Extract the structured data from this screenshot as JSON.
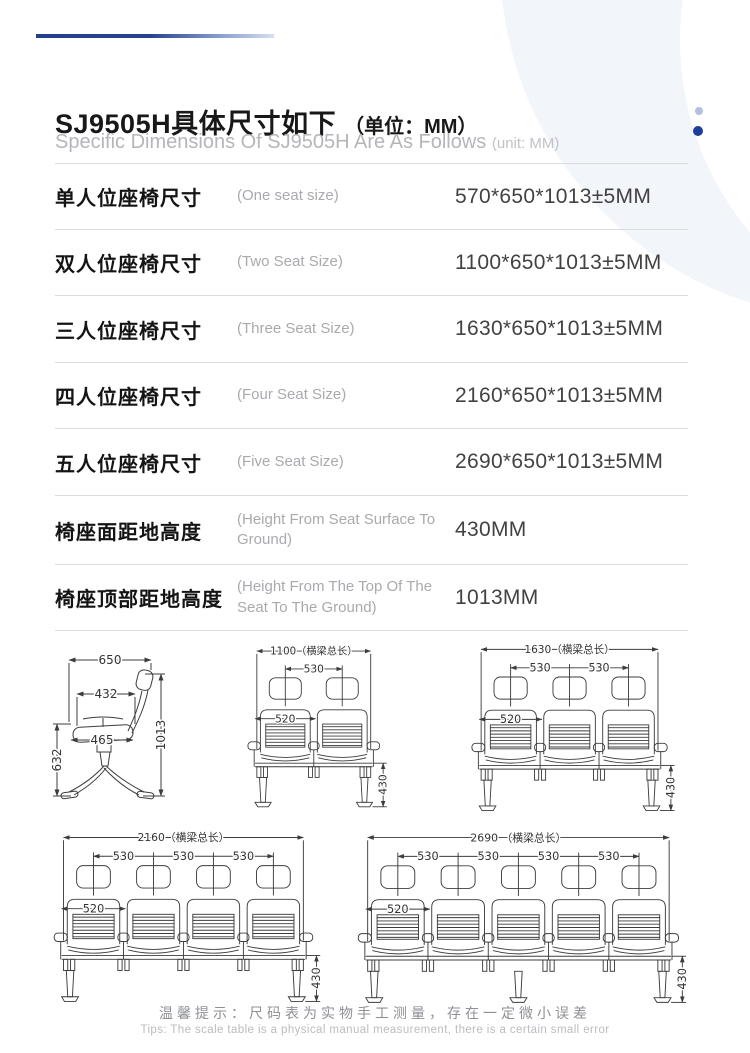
{
  "header": {
    "title_zh": "SJ9505H具体尺寸如下",
    "title_unit": "（单位：MM）",
    "subtitle_en": "Specific Dimensions Of SJ9505H Are As Follows",
    "subtitle_unit": "(unit: MM)",
    "accent_color": "#22408e",
    "dot_light_color": "#b4c0de",
    "dot_dark_color": "#1d3f9b"
  },
  "spec_table": {
    "rows": [
      {
        "label_zh": "单人位座椅尺寸",
        "label_en": "(One seat size)",
        "value": "570*650*1013±5MM"
      },
      {
        "label_zh": "双人位座椅尺寸",
        "label_en": "(Two Seat Size)",
        "value": "1100*650*1013±5MM"
      },
      {
        "label_zh": "三人位座椅尺寸",
        "label_en": "(Three Seat Size)",
        "value": "1630*650*1013±5MM"
      },
      {
        "label_zh": "四人位座椅尺寸",
        "label_en": "(Four Seat Size)",
        "value": "2160*650*1013±5MM"
      },
      {
        "label_zh": "五人位座椅尺寸",
        "label_en": "(Five Seat Size)",
        "value": "2690*650*1013±5MM"
      },
      {
        "label_zh": "椅座面距地高度",
        "label_en": "(Height From Seat Surface To Ground)",
        "value": "430MM"
      },
      {
        "label_zh": "椅座顶部距地高度",
        "label_en": "(Height From The Top Of The Seat To The Ground)",
        "value": "1013MM"
      }
    ]
  },
  "diagrams": {
    "side_view": {
      "dims": {
        "depth": "650",
        "seat_depth": "432",
        "seat_length": "465",
        "total_height": "1013",
        "under_height": "632"
      }
    },
    "front_views": [
      {
        "seats": 2,
        "beam_label": "1100（横梁总长）",
        "pitch_label": "530",
        "back_label": "520",
        "leg_label": "430"
      },
      {
        "seats": 3,
        "beam_label": "1630（横梁总长）",
        "pitch_label": "530",
        "back_label": "520",
        "leg_label": "430"
      },
      {
        "seats": 4,
        "beam_label": "2160（横梁总长）",
        "pitch_label": "530",
        "back_label": "520",
        "leg_label": "430"
      },
      {
        "seats": 5,
        "beam_label": "2690 （横梁总长）",
        "pitch_label": "530",
        "back_label": "520",
        "leg_label": "430"
      }
    ]
  },
  "footer": {
    "tip_zh": "温馨提示：尺码表为实物手工测量，存在一定微小误差",
    "tip_en": "Tips: The scale table is a physical manual measurement, there is a certain small error"
  }
}
